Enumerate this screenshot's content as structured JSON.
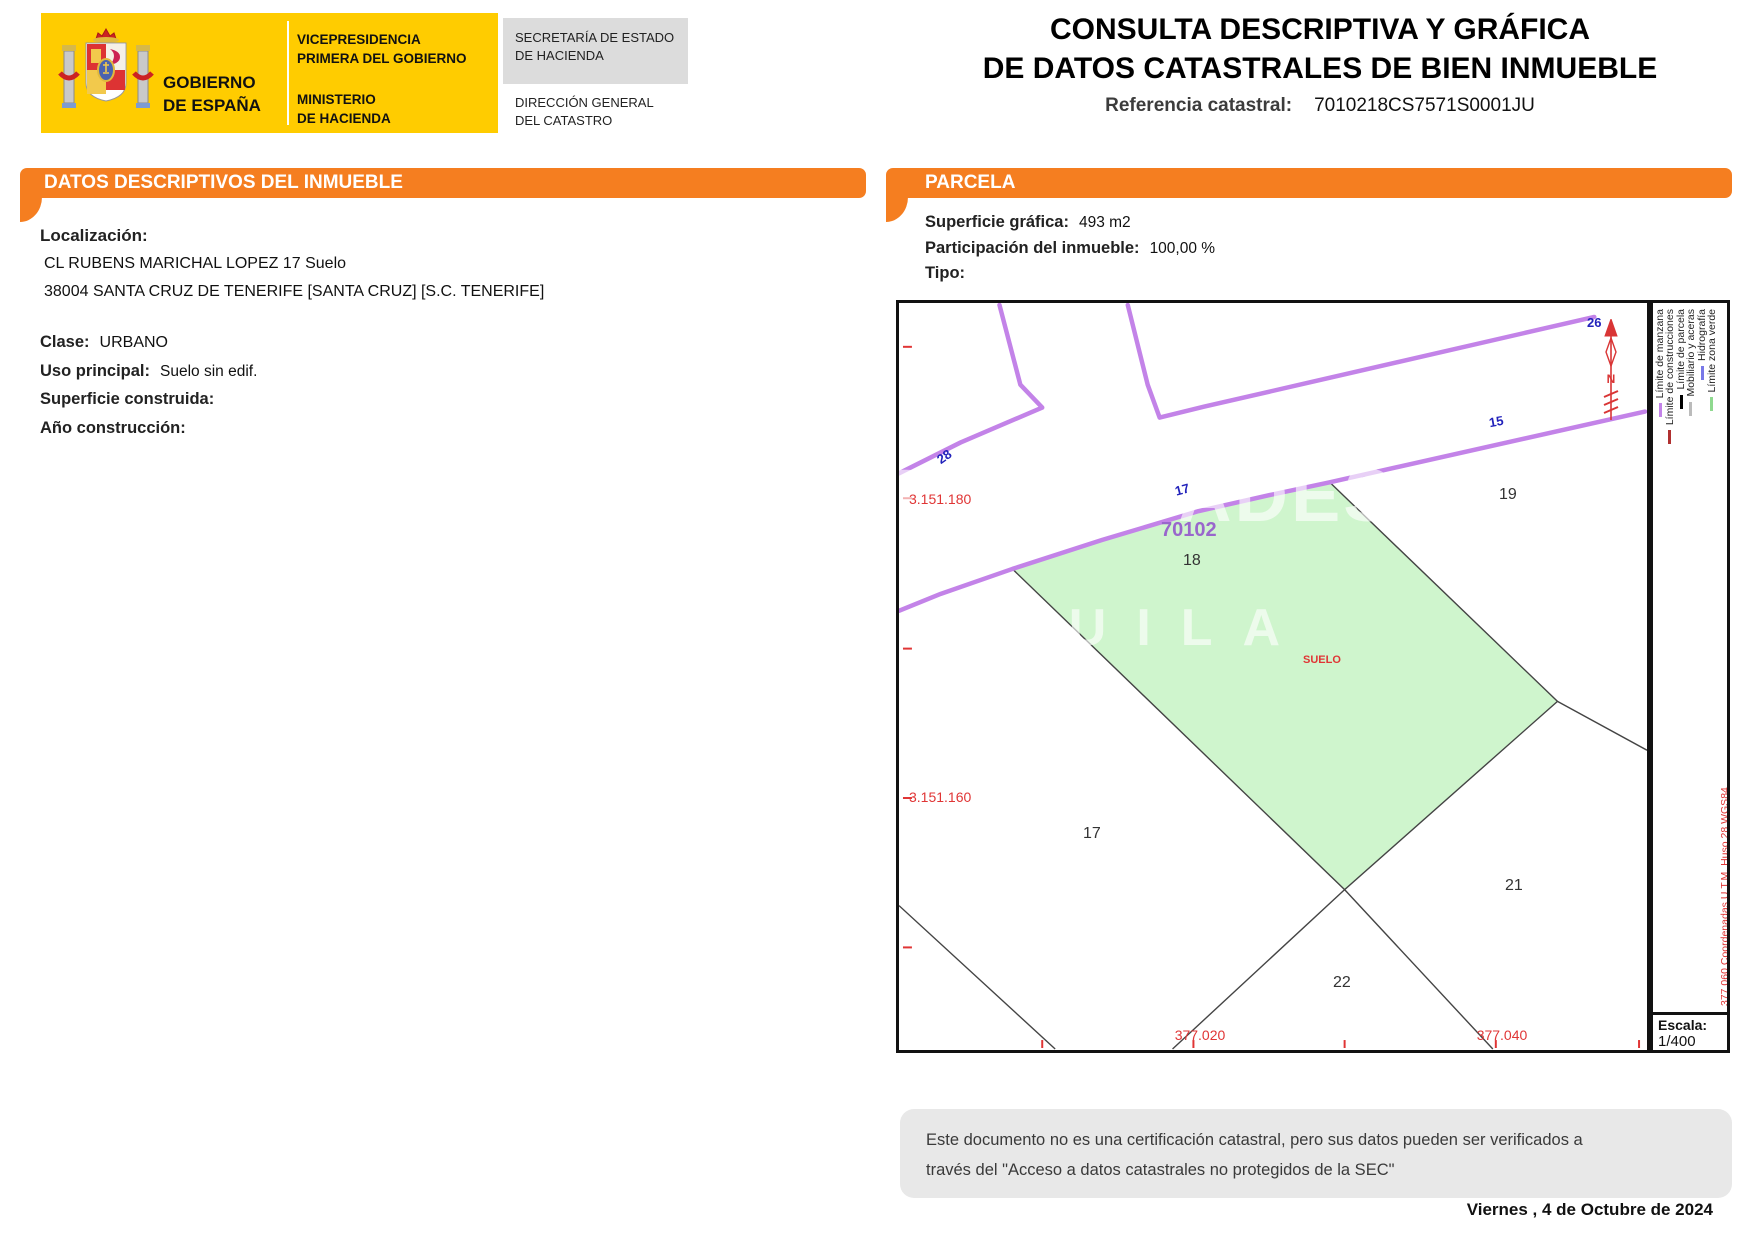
{
  "header": {
    "logo": {
      "gobierno_line1": "GOBIERNO",
      "gobierno_line2": "DE ESPAÑA",
      "vicepresidencia_line1": "VICEPRESIDENCIA",
      "vicepresidencia_line2": "PRIMERA DEL GOBIERNO",
      "ministerio_line1": "MINISTERIO",
      "ministerio_line2": "DE HACIENDA",
      "secretaria_line1": "SECRETARÍA DE ESTADO",
      "secretaria_line2": "DE HACIENDA",
      "direccion_line1": "DIRECCIÓN GENERAL",
      "direccion_line2": "DEL CATASTRO"
    },
    "title_line1": "CONSULTA DESCRIPTIVA Y GRÁFICA",
    "title_line2": "DE DATOS CATASTRALES DE BIEN INMUEBLE",
    "ref_label": "Referencia catastral:",
    "ref_value": "7010218CS7571S0001JU"
  },
  "inmueble": {
    "section_title": "DATOS DESCRIPTIVOS DEL INMUEBLE",
    "localizacion_label": "Localización:",
    "address_line1": "CL RUBENS MARICHAL LOPEZ 17 Suelo",
    "address_line2": "38004 SANTA CRUZ DE TENERIFE [SANTA CRUZ] [S.C. TENERIFE]",
    "clase_label": "Clase:",
    "clase_value": "URBANO",
    "uso_label": "Uso principal:",
    "uso_value": "Suelo sin edif.",
    "superficie_label": "Superficie construida:",
    "superficie_value": "",
    "ano_label": "Año construcción:",
    "ano_value": ""
  },
  "parcela": {
    "section_title": "PARCELA",
    "superficie_label": "Superficie gráfica:",
    "superficie_value": "493 m2",
    "participacion_label": "Participación del inmueble:",
    "participacion_value": "100,00 %",
    "tipo_label": "Tipo:",
    "tipo_value": ""
  },
  "map": {
    "street_numbers": [
      "28",
      "17",
      "15",
      "26"
    ],
    "parcel_numbers": [
      "19",
      "18",
      "17",
      "21",
      "22"
    ],
    "manzana_number": "70102",
    "land_use_label": "SUELO",
    "utm_y_labels": [
      "3.151.180",
      "3.151.160"
    ],
    "utm_x_labels": [
      "377.020",
      "377.040"
    ],
    "watermark_line1": "PROPIEDADES",
    "watermark_line2": "ALQUILA",
    "north_letter": "N",
    "colors": {
      "manzana_line": "#C383E8",
      "parcel_fill": "#CFF5CD",
      "coord_red": "#E03535",
      "street_number_blue": "#2222BB",
      "manzana_text": "#9966CC",
      "section_orange": "#F57E20",
      "logo_yellow": "#FFCC00"
    }
  },
  "legend": {
    "items": [
      {
        "label": "Límite de manzana",
        "color": "#C383E8"
      },
      {
        "label": "Límite de construcciones",
        "color": "#B03030"
      },
      {
        "label": "Límite de parcela",
        "color": "#000000"
      },
      {
        "label": "Mobiliario y aceras",
        "color": "#BBBBBB"
      },
      {
        "label": "Hidrografía",
        "color": "#7878E8"
      },
      {
        "label": "Límite zona verde",
        "color": "#8FD98F"
      }
    ],
    "coords_note": "377.060  Coordenadas U.T.M. Huso 28 WGS84",
    "cert_note": "Este documento electrónico contiene anexos con las coordenadas de los vértices UTM de la parcela y los datos de la certificación",
    "escala_label": "Escala:",
    "escala_value": "1/400"
  },
  "footer": {
    "disclaimer_line1": "Este documento no es una certificación catastral, pero sus datos pueden ser verificados a",
    "disclaimer_line2": "través del \"Acceso a datos catastrales no protegidos de la SEC\"",
    "date": "Viernes , 4 de Octubre de 2024"
  }
}
